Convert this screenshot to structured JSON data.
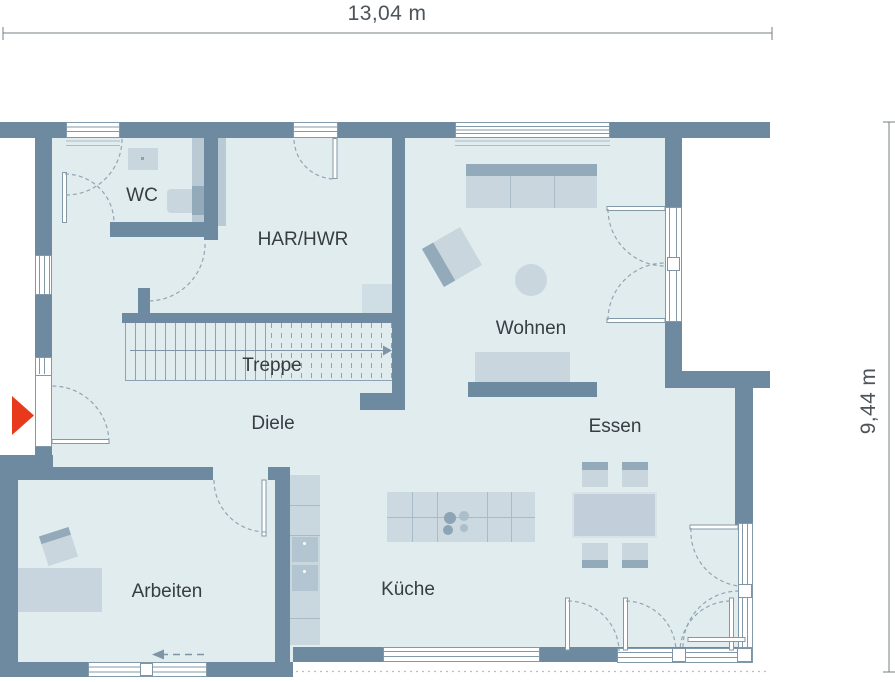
{
  "dimensions": {
    "width_label": "13,04 m",
    "depth_label": "9,44 m"
  },
  "rooms": {
    "wc": {
      "label": "WC"
    },
    "har_hwr": {
      "label": "HAR/HWR"
    },
    "treppe": {
      "label": "Treppe"
    },
    "wohnen": {
      "label": "Wohnen"
    },
    "diele": {
      "label": "Diele"
    },
    "essen": {
      "label": "Essen"
    },
    "arbeiten": {
      "label": "Arbeiten"
    },
    "kueche": {
      "label": "Küche"
    }
  },
  "markers": {
    "entrance_icon": "entrance-arrow",
    "stairs_direction": "up-to-right",
    "sliding_door_direction": "left"
  },
  "colors": {
    "wall": "#6e8aa1",
    "floor": "#e1ecef",
    "furniture_light": "#c9d6de",
    "furniture_dark": "#93aaba",
    "frame_line": "#8299a9",
    "door_swing_dash": "#93a5b2",
    "entrance_arrow": "#e8391d",
    "dimension_text": "#4d5358",
    "room_label_text": "#363d43",
    "outside": "#ffffff"
  }
}
